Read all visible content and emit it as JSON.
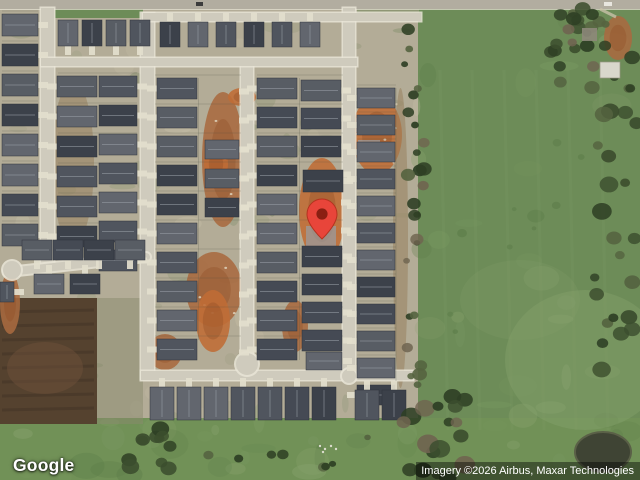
{
  "logo": {
    "text": "Google"
  },
  "attribution": {
    "text": "Imagery ©2026 Airbus, Maxar Technologies"
  },
  "marker": {
    "tip_x": 322,
    "tip_y": 240,
    "body_color": "#e8453a",
    "edge_color": "#b5321f",
    "dot_color": "#8a1f12"
  },
  "map": {
    "colors": {
      "lot_tan": "#b3ac97",
      "sage": "#8e9674",
      "sage2": "#7c8a66",
      "tan_light": "#c9c1a8",
      "field": "#6d8c58",
      "field_dark": "#5d7d4a",
      "field_light": "#88a26d",
      "strip_green": "#719157",
      "street": "#cfcbbd",
      "curb": "#e9e5d7",
      "road": "#b2ada0",
      "drive": "#e3decd",
      "dirt_hot": "#bf6c35",
      "dirt_mid": "#a96a40",
      "dirt_soft": "#97815f",
      "dirt_dark": "#8f4e24",
      "debris": "#ded2bb",
      "ridge": "#9aa0a8",
      "slab": "#999b9e",
      "house_palette": [
        "#454a54",
        "#50555e",
        "#3c414a",
        "#585d64",
        "#62666e"
      ],
      "tree_green": "#3c4e2e",
      "tree_dark": "#2e3f24",
      "tree_olive": "#556340",
      "tree_bare": "#6f6450",
      "dark_field": "#55422f",
      "dark_field2": "#433527",
      "dark_field3": "#6e4f39",
      "pond": "#3f4434",
      "pond_rim": "#5a6047",
      "building": "#d9d7cc",
      "car": "#3c3c3c"
    },
    "green_areas": [
      {
        "x": 418,
        "y": 0,
        "w": 222,
        "h": 480,
        "c": "field"
      },
      {
        "x": 0,
        "y": 418,
        "w": 640,
        "h": 62,
        "c": "strip_green"
      },
      {
        "x": 55,
        "y": 9,
        "w": 88,
        "h": 9,
        "c": "field"
      },
      {
        "x": 357,
        "y": 9,
        "w": 62,
        "h": 10,
        "c": "sage"
      }
    ],
    "dark_field": {
      "x": 0,
      "y": 298,
      "w": 97,
      "h": 126
    },
    "dirt_patches": [
      {
        "x": 202,
        "y": 92,
        "w": 42,
        "h": 135,
        "tone": "dirt_mid",
        "sp": true
      },
      {
        "x": 228,
        "y": 88,
        "w": 28,
        "h": 18,
        "tone": "dirt_hot"
      },
      {
        "x": 204,
        "y": 146,
        "w": 24,
        "h": 36,
        "tone": "dirt_hot"
      },
      {
        "x": 186,
        "y": 252,
        "w": 56,
        "h": 75,
        "tone": "dirt_mid",
        "sp": true
      },
      {
        "x": 196,
        "y": 290,
        "w": 34,
        "h": 62,
        "tone": "dirt_hot"
      },
      {
        "x": 282,
        "y": 300,
        "w": 26,
        "h": 52,
        "tone": "dirt_mid"
      },
      {
        "x": 299,
        "y": 158,
        "w": 46,
        "h": 105,
        "tone": "dirt_hot"
      },
      {
        "x": 352,
        "y": 96,
        "w": 50,
        "h": 78,
        "tone": "dirt_hot",
        "sp": true
      },
      {
        "x": 604,
        "y": 16,
        "w": 28,
        "h": 44,
        "tone": "dirt_mid"
      },
      {
        "x": 0,
        "y": 272,
        "w": 20,
        "h": 62,
        "tone": "dirt_mid"
      },
      {
        "x": 148,
        "y": 334,
        "w": 34,
        "h": 36,
        "tone": "dirt_mid"
      },
      {
        "x": 52,
        "y": 80,
        "w": 42,
        "h": 165,
        "tone": "dirt_soft"
      },
      {
        "x": 393,
        "y": 88,
        "w": 15,
        "h": 300,
        "tone": "dirt_soft"
      }
    ],
    "slabs": [
      {
        "x": 356,
        "y": 118,
        "w": 24,
        "h": 14
      },
      {
        "x": 358,
        "y": 140,
        "w": 22,
        "h": 12
      },
      {
        "x": 306,
        "y": 226,
        "w": 30,
        "h": 26
      }
    ],
    "road": {
      "x": 0,
      "y": 0,
      "w": 640,
      "h": 9
    },
    "streets": [
      {
        "x": 41,
        "y": 8,
        "w": 13,
        "h": 256
      },
      {
        "x": 141,
        "y": 13,
        "w": 13,
        "h": 366
      },
      {
        "x": 241,
        "y": 60,
        "w": 12,
        "h": 304
      },
      {
        "x": 343,
        "y": 8,
        "w": 12,
        "h": 371
      },
      {
        "x": 143,
        "y": 13,
        "w": 278,
        "h": 8
      },
      {
        "x": 41,
        "y": 58,
        "w": 316,
        "h": 8
      },
      {
        "x": 141,
        "y": 371,
        "w": 272,
        "h": 9
      }
    ],
    "diag_street": {
      "x1": 8,
      "y1": 272,
      "x2": 146,
      "y2": 257
    },
    "bulbs": [
      {
        "x": 247,
        "y": 364,
        "r": 11
      },
      {
        "x": 12,
        "y": 270,
        "r": 9
      },
      {
        "x": 349,
        "y": 376,
        "r": 7
      }
    ],
    "house_rows": [
      {
        "x": 2,
        "y": 14,
        "w": 36,
        "h": 22,
        "n": 8,
        "dy": 30,
        "drive": "right"
      },
      {
        "x": 58,
        "y": 20,
        "w": 20,
        "h": 26,
        "n": 4,
        "dx": 24,
        "drive": "down"
      },
      {
        "x": 160,
        "y": 22,
        "w": 20,
        "h": 25,
        "n": 6,
        "dx": 28,
        "drive": "up"
      },
      {
        "x": 57,
        "y": 76,
        "w": 40,
        "h": 21,
        "n": 6,
        "dy": 30,
        "drive": "left"
      },
      {
        "x": 99,
        "y": 76,
        "w": 38,
        "h": 21,
        "n": 7,
        "dy": 29,
        "drive": "right"
      },
      {
        "x": 157,
        "y": 78,
        "w": 40,
        "h": 21,
        "n": 10,
        "dy": 29,
        "drive": "left"
      },
      {
        "x": 205,
        "y": 82,
        "w": 34,
        "h": 19,
        "n": 10,
        "dy": 29,
        "drive": "right",
        "ghost": true
      },
      {
        "x": 205,
        "y": 140,
        "w": 34,
        "h": 19,
        "n": 3,
        "dy": 29,
        "drive": "right"
      },
      {
        "x": 257,
        "y": 78,
        "w": 40,
        "h": 21,
        "n": 10,
        "dy": 29,
        "drive": "left"
      },
      {
        "x": 301,
        "y": 80,
        "w": 40,
        "h": 21,
        "n": 6,
        "dy": 28,
        "drive": "right",
        "ghost": true
      },
      {
        "x": 301,
        "y": 80,
        "w": 40,
        "h": 21,
        "n": 3,
        "dy": 28,
        "drive": "right"
      },
      {
        "x": 303,
        "y": 170,
        "w": 40,
        "h": 22,
        "n": 1,
        "drive": "right"
      },
      {
        "x": 302,
        "y": 246,
        "w": 40,
        "h": 21,
        "n": 4,
        "dy": 28,
        "drive": "right"
      },
      {
        "x": 306,
        "y": 352,
        "w": 36,
        "h": 18,
        "n": 1,
        "drive": "right"
      },
      {
        "x": 357,
        "y": 88,
        "w": 38,
        "h": 20,
        "n": 12,
        "dy": 27,
        "drive": "left"
      },
      {
        "x": 150,
        "y": 387,
        "w": 24,
        "h": 33,
        "n": 7,
        "dx": 27,
        "drive": "up"
      },
      {
        "x": 355,
        "y": 390,
        "w": 24,
        "h": 30,
        "n": 2,
        "dx": 27,
        "drive": "up"
      },
      {
        "x": 22,
        "y": 240,
        "w": 30,
        "h": 20,
        "n": 4,
        "dx": 31,
        "drive": "down"
      },
      {
        "x": 34,
        "y": 274,
        "w": 30,
        "h": 20,
        "n": 2,
        "dx": 36,
        "drive": "up"
      },
      {
        "x": 0,
        "y": 282,
        "w": 14,
        "h": 20,
        "n": 1,
        "drive": "right"
      }
    ],
    "lot_line_blocks": [
      {
        "x": 155,
        "w": 86,
        "y0": 78,
        "dy": 29,
        "n": 10
      },
      {
        "x": 257,
        "w": 86,
        "y0": 78,
        "dy": 29,
        "n": 10
      },
      {
        "x": 357,
        "w": 39,
        "y0": 88,
        "dy": 27,
        "n": 11
      },
      {
        "x": 2,
        "w": 36,
        "y0": 14,
        "dy": 30,
        "n": 8
      },
      {
        "x": 58,
        "w": 79,
        "y0": 76,
        "dy": 30,
        "n": 6
      }
    ],
    "fences": [
      {
        "x": 198.5,
        "y0": 78,
        "y1": 340
      },
      {
        "x": 299.5,
        "y0": 78,
        "y1": 360
      },
      {
        "x": 396,
        "y0": 88,
        "y1": 400
      }
    ],
    "tree_clusters": [
      {
        "x0": 404,
        "x1": 424,
        "y0": 14,
        "y1": 392,
        "n": 26,
        "r0": 3,
        "r1": 8,
        "c": [
          "tree_bare",
          "tree_dark",
          "tree_olive"
        ]
      },
      {
        "x0": 594,
        "x1": 638,
        "y0": 55,
        "y1": 475,
        "n": 30,
        "r0": 4,
        "r1": 10,
        "c": [
          "tree_green",
          "tree_dark",
          "tree_olive"
        ]
      },
      {
        "x0": 388,
        "x1": 465,
        "y0": 395,
        "y1": 478,
        "n": 18,
        "r0": 5,
        "r1": 11,
        "c": [
          "tree_dark",
          "tree_green",
          "tree_bare"
        ]
      },
      {
        "x0": 128,
        "x1": 172,
        "y0": 420,
        "y1": 478,
        "n": 11,
        "r0": 4,
        "r1": 9,
        "c": [
          "tree_dark",
          "tree_green"
        ]
      },
      {
        "x0": 545,
        "x1": 608,
        "y0": 6,
        "y1": 55,
        "n": 13,
        "r0": 4,
        "r1": 9,
        "c": [
          "tree_green",
          "tree_olive",
          "tree_dark"
        ]
      },
      {
        "x0": 556,
        "x1": 600,
        "y0": 14,
        "y1": 88,
        "n": 10,
        "r0": 4,
        "r1": 8,
        "c": [
          "tree_dark",
          "tree_bare",
          "tree_olive"
        ]
      },
      {
        "x0": 430,
        "x1": 590,
        "y0": 70,
        "y1": 420,
        "n": 9,
        "r0": 2,
        "r1": 5,
        "c": [
          "field_dark"
        ],
        "op": 0.5
      },
      {
        "x0": 175,
        "x1": 370,
        "y0": 425,
        "y1": 470,
        "n": 8,
        "r0": 3,
        "r1": 6,
        "c": [
          "tree_dark",
          "tree_olive"
        ]
      }
    ],
    "pond": {
      "cx": 603,
      "cy": 452,
      "rx": 28,
      "ry": 20
    },
    "building": {
      "x": 600,
      "y": 62,
      "w": 20,
      "h": 16
    },
    "gray_blob": {
      "x": 582,
      "y": 28,
      "w": 15,
      "h": 13
    },
    "cars": [
      {
        "x": 196,
        "y": 2,
        "w": 7,
        "h": 4
      },
      {
        "x": 604,
        "y": 2,
        "w": 8,
        "h": 4,
        "light": true
      }
    ],
    "white_specks": [
      [
        320,
        446
      ],
      [
        325,
        449
      ],
      [
        331,
        446
      ],
      [
        336,
        449
      ],
      [
        323,
        452
      ]
    ]
  }
}
